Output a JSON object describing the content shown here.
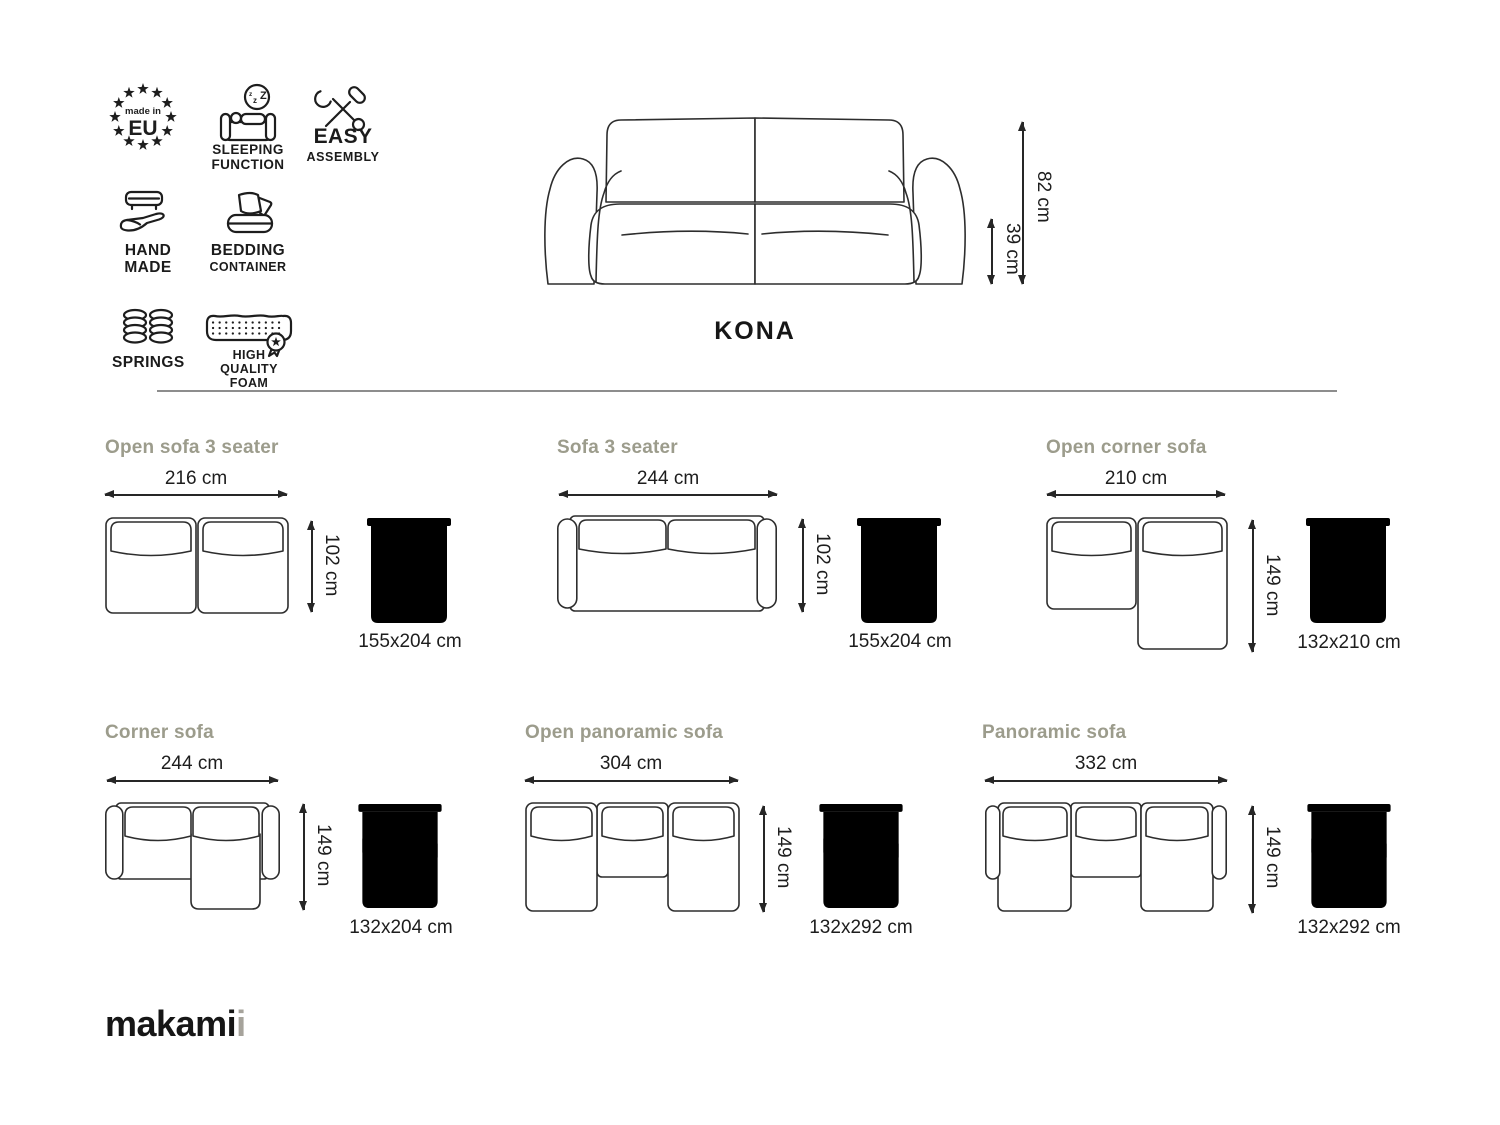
{
  "header": {
    "badges": {
      "made_in_eu": {
        "top": "made in",
        "main": "EU"
      },
      "sleeping_function": {
        "lines": [
          "SLEEPING",
          "FUNCTION"
        ]
      },
      "easy_assembly": {
        "lines": [
          "EASY",
          "ASSEMBLY"
        ]
      },
      "hand_made": {
        "lines": [
          "HAND",
          "MADE"
        ]
      },
      "bedding_container": {
        "lines": [
          "BEDDING",
          "CONTAINER"
        ]
      },
      "springs": {
        "label": "SPRINGS"
      },
      "high_quality_foam": {
        "lines": [
          "HIGH QUALITY",
          "FOAM"
        ]
      }
    },
    "product_name": "KONA",
    "dimensions": {
      "total_height": "82 cm",
      "seat_height": "39 cm"
    }
  },
  "configurations": [
    {
      "title": "Open sofa 3 seater",
      "width": "216 cm",
      "depth": "102 cm",
      "bed_size": "155x204 cm"
    },
    {
      "title": "Sofa 3 seater",
      "width": "244 cm",
      "depth": "102 cm",
      "bed_size": "155x204 cm"
    },
    {
      "title": "Open corner sofa",
      "width": "210 cm",
      "depth": "149 cm",
      "bed_size": "132x210 cm"
    },
    {
      "title": "Corner sofa",
      "width": "244 cm",
      "depth": "149 cm",
      "bed_size": "132x204 cm"
    },
    {
      "title": "Open panoramic sofa",
      "width": "304 cm",
      "depth": "149 cm",
      "bed_size": "132x292 cm"
    },
    {
      "title": "Panoramic sofa",
      "width": "332 cm",
      "depth": "149 cm",
      "bed_size": "132x292 cm"
    }
  ],
  "footer": {
    "brand_main": "makami",
    "brand_accent": "i"
  },
  "colors": {
    "line_art": "#2d2d2d",
    "section_title": "#9c9c8c",
    "text": "#1d1d1d",
    "brand_accent": "#a6a39b"
  }
}
